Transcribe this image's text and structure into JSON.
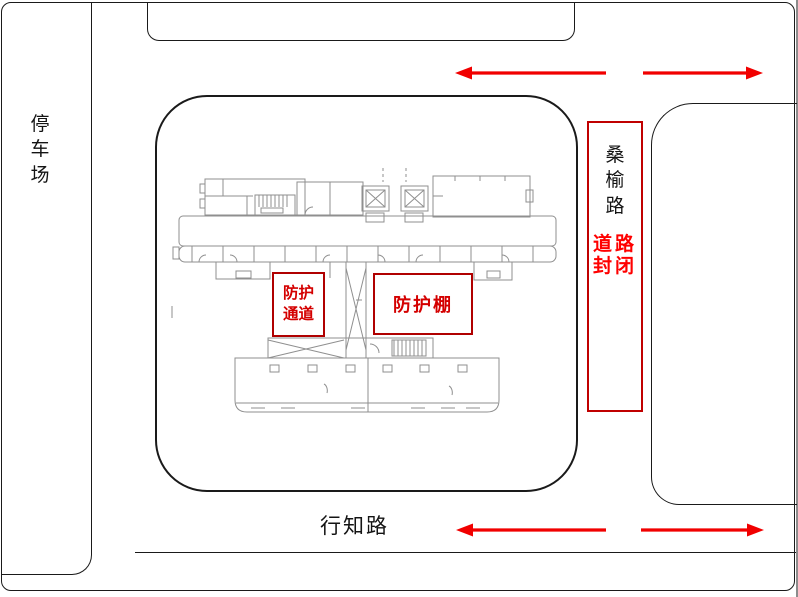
{
  "areas": {
    "parking": {
      "label": "停车场"
    },
    "sangyu_road": {
      "name": "桑榆路",
      "closure_notice": "道路封闭"
    },
    "xingzhi_road": {
      "name": "行知路"
    },
    "construction_site": {
      "content": "building floor plan"
    }
  },
  "site": {
    "protection_passage_label": "防护通道",
    "protection_shed_label": "防护棚"
  },
  "traffic_arrows": [
    {
      "location": "top-road-west",
      "direction": "left"
    },
    {
      "location": "top-road-east",
      "direction": "right"
    },
    {
      "location": "bottom-road-west",
      "direction": "left"
    },
    {
      "location": "bottom-road-east",
      "direction": "right"
    }
  ],
  "colors": {
    "arrow_red": "#f10000",
    "closure_border_red": "#c00000",
    "label_box_border_red": "#b00000",
    "label_text_red": "#d40000",
    "notice_text_red": "#ff0000",
    "outline_black": "#1a1a1a",
    "floor_plan_gray": "#8f8f8f"
  }
}
